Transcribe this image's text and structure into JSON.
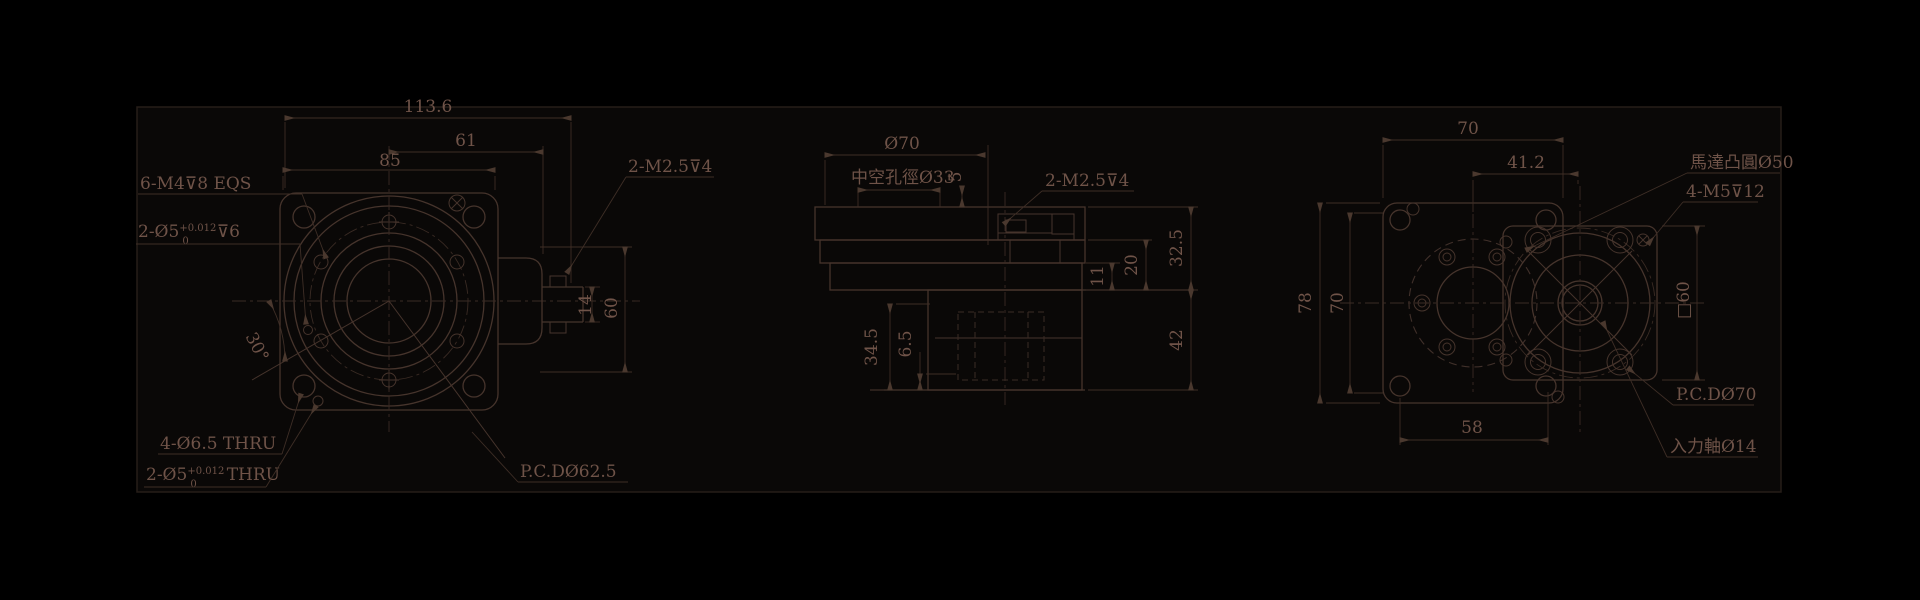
{
  "front": {
    "dim_total": "113.6",
    "dim_upper": "61",
    "dim_flange": "85",
    "angle": "30°",
    "dim_shaft": "14",
    "dim_tab": "60",
    "label_m4": "6-M4⊽8 EQS",
    "pin6_base": "2-Ø5",
    "pin6_sup": "+0.012",
    "pin6_sub": "0",
    "pin6_tail": "⊽6",
    "label_m25": "2-M2.5⊽4",
    "label_thru65": "4-Ø6.5 THRU",
    "pinthru_base": "2-Ø5",
    "pinthru_sup": "+0.012",
    "pinthru_sub": "0",
    "pinthru_tail": "THRU",
    "label_pcd": "P.C.DØ62.5"
  },
  "section": {
    "dim_od": "Ø70",
    "label_bore": "中空孔徑Ø33",
    "dim_step": "5",
    "label_m25": "2-M2.5⊽4",
    "dim_11": "11",
    "dim_20": "20",
    "dim_325": "32.5",
    "dim_42": "42",
    "dim_345": "34.5",
    "dim_65": "6.5"
  },
  "side": {
    "dim_width": "70",
    "dim_offset": "41.2",
    "dim_height": "78",
    "dim_inner": "70",
    "dim_holes": "58",
    "dim_square": "□60",
    "label_boss": "馬達凸圓Ø50",
    "label_m5": "4-M5⊽12",
    "label_pcd": "P.C.DØ70",
    "label_shaft": "入力軸Ø14"
  },
  "colors": {
    "background": "#000000",
    "canvas": "#0a0807",
    "line": "#46342c",
    "text": "#6f5348"
  }
}
